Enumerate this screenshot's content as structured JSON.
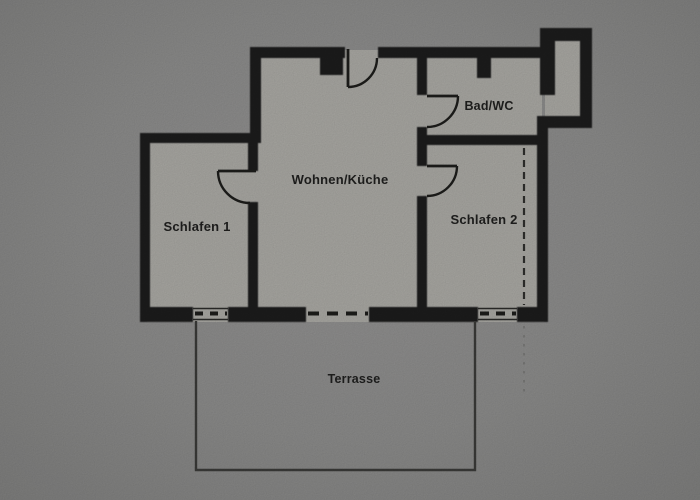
{
  "floor_plan": {
    "rooms": {
      "schlafen1": {
        "label": "Schlafen 1"
      },
      "wohnen_kueche": {
        "label": "Wohnen/Küche"
      },
      "bad_wc": {
        "label": "Bad/WC"
      },
      "schlafen2": {
        "label": "Schlafen 2"
      },
      "terrasse": {
        "label": "Terrasse"
      }
    },
    "colors": {
      "paper": "#8b8b8a",
      "interior": "#a9a8a3",
      "wall": "#1d1d1b",
      "text": "#1f1f1e"
    }
  }
}
